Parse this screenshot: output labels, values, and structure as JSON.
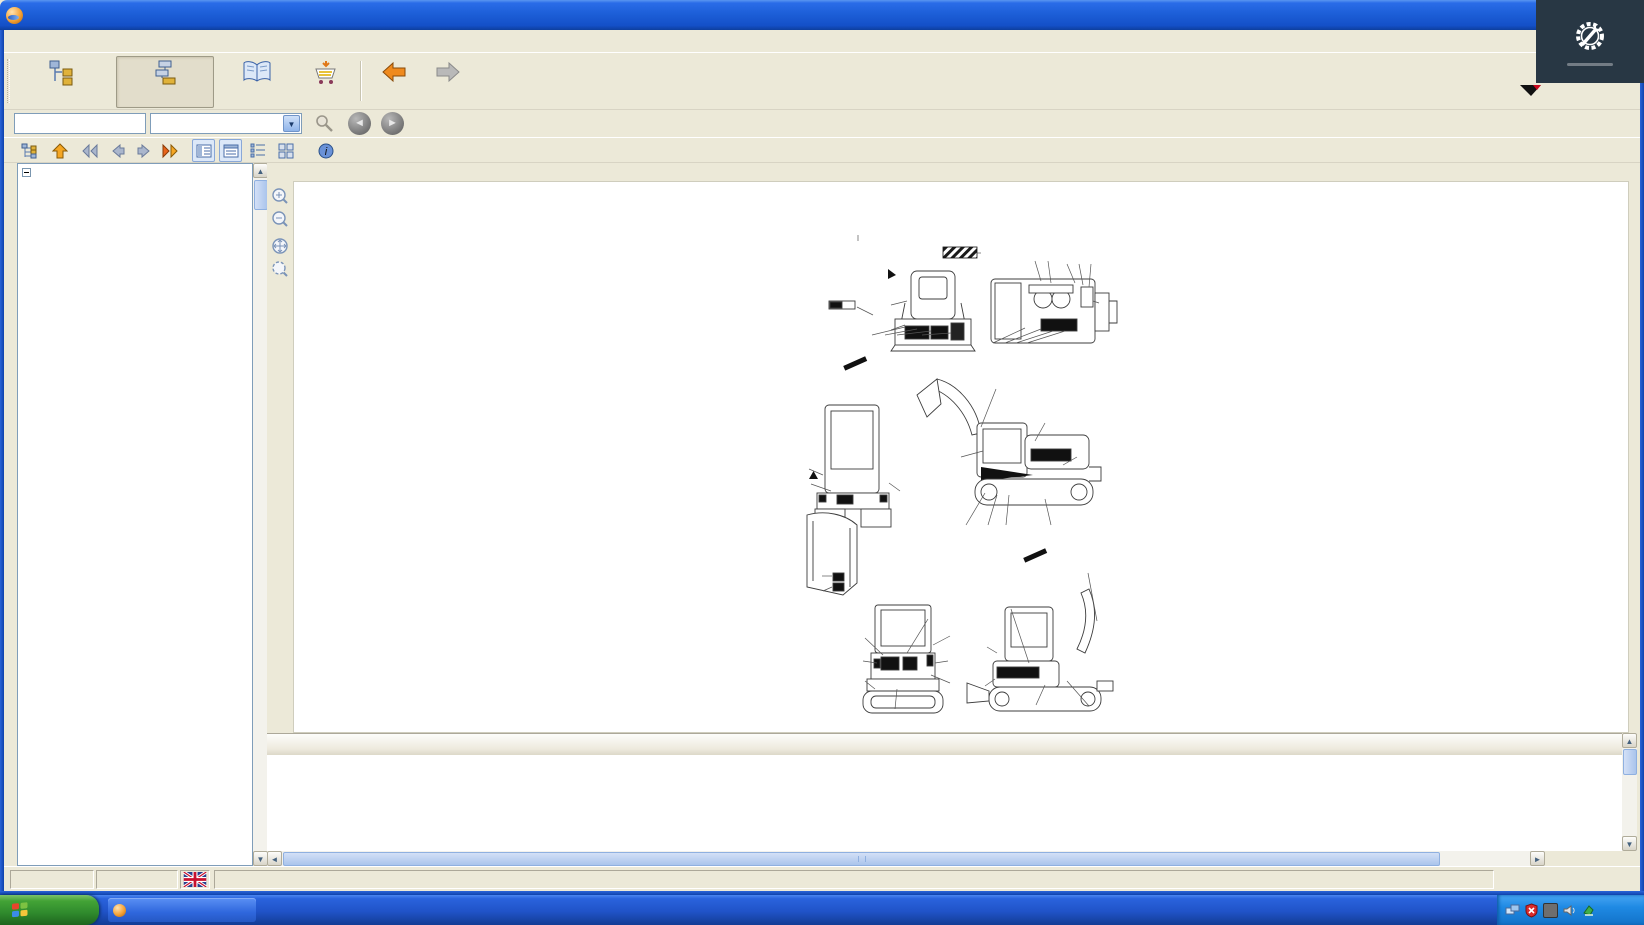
{
  "window": {
    "title": "PARTS-PUBLISHER - Catalog"
  },
  "overlay": {
    "brand": "AGCF Machinery Diag",
    "yanmar": "YANMAR"
  },
  "menu": {
    "items": [
      {
        "label": "File",
        "u": 0
      },
      {
        "label": "View",
        "u": 0
      },
      {
        "label": "Print",
        "u": 4
      },
      {
        "label": "Options",
        "u": 0
      },
      {
        "label": "Help",
        "u": 0
      }
    ]
  },
  "toolbar": {
    "main_selection": "Main selection",
    "catalogue": "Catalogue of parts",
    "documentation": "Documentation",
    "order": "Order",
    "back": "Back",
    "next": "Next"
  },
  "search": {
    "value": "",
    "field_type": "Part no."
  },
  "content": {
    "header": "(1) LABEL (CABIN SPEC.)[|->|]",
    "expand": "»"
  },
  "tree": {
    "root": "VEHICLE",
    "items": [
      {
        "label": "(1) LABEL (CABIN SPEC.)[|->|]",
        "selected": true
      },
      {
        "label": "(2) LABEL(CABIN SPEC.)[|->|]"
      },
      {
        "label": "(3) LABEL (CANOPY SPEC.)[|->|]"
      },
      {
        "label": "(4) LABEL(CANOPY SPEC.)[|->|]"
      },
      {
        "label": "(5) LABEL(UK REMODELING)OPTIONAL[|->|]"
      },
      {
        "label": "(6) TOOL,TOOLS BOX & MANUAL CASE[|->|]"
      },
      {
        "label": "(7) MUFFLER[|->|]"
      },
      {
        "label": "(8) AIR CLEANER[|->|]"
      },
      {
        "label": "(9) ACCELERATOR[|->|]"
      },
      {
        "label": "(10) ENGINE MOUNT[|->|]"
      },
      {
        "label": "(11) RADIATOR & MOUNT[|->|]"
      },
      {
        "label": "(12) FUEL TANK & FUEL LINE[|->|]"
      },
      {
        "label": "(13) BATTERY[|->|]"
      },
      {
        "label": "(14) ELECTRIC PART(CABIN SPEC.)[|->|]"
      },
      {
        "label": "(15) ELECTRIC PART(CANOPY SPEC.)[|->|]"
      },
      {
        "label": "(16) WORK LAMP[|->|]"
      },
      {
        "label": "(17) HEATER & DEFROSTER[|->|]"
      },
      {
        "label": "(18) RADIO (SWISS SPEC.)[|->|]"
      },
      {
        "label": "(19) ROLLER & ADJUST[|->|]"
      },
      {
        "label": "(20) CRAWLER (320)[|->|]"
      },
      {
        "label": "(21) LINK STAND[|->|]"
      },
      {
        "label": "(22) CONTROL EQUIPME.(BOOM & BUCKET)[|->|]"
      },
      {
        "label": "(23) CONTROL EQUIPME.(ARM & TURNING)[|->|]"
      },
      {
        "label": "(24) CONTROL EQUIPME.(DRIVE & SWING)[|->|]"
      },
      {
        "label": "(25) CONTROL EQUIPMENT (BLADE)[|->|]"
      },
      {
        "label": "(26) CONTROL EQUIPMENT(3RD VALVE)[|->|]"
      },
      {
        "label": "(27) OPERATION LEVER STOPPER[|->|]"
      },
      {
        "label": "(28) FRAME[|->|]"
      },
      {
        "label": "(29) TURNING BEARING & TURNING LOCK[|->|]"
      },
      {
        "label": "(30) FRAME COVER[|->|]"
      },
      {
        "label": "(31) STEP,INSTRUMENT PANEL & SEAT[|->|]"
      },
      {
        "label": "(32) BONNET[|->|]"
      },
      {
        "label": "(33) CANOPY[|->|]"
      },
      {
        "label": "(34) CABIN[|->|]"
      },
      {
        "label": "(35) BOOM CYLINDER(UA)(CABINE SPEC.)[|->|]"
      },
      {
        "label": "(36) BOOM CYLINDER(UZ)(CANOPY SPEC.)[|->|]"
      },
      {
        "label": "(37) ARM CYLINDER[|->|]"
      },
      {
        "label": "(38) BUCKET CYLINDER[|->|]"
      },
      {
        "label": "(39) SWING CYLINDER[|->|]"
      },
      {
        "label": "(40) BLADE CYLINDER[|->|]"
      }
    ]
  },
  "diagram": {
    "fig_label": "Fig.",
    "fig_no": "1",
    "title_jp": "メイバン(キャビン)",
    "title_en": "LABEL (CABIN SPEC.)",
    "fig_table": [
      [
        "COUNTRY",
        "AY",
        "UK",
        "EP",
        "UK(OPT"
      ],
      [
        "Fig No.",
        "1",
        "2",
        "1",
        "5"
      ]
    ],
    "app_tables": [
      {
        "x": 53,
        "y": 190,
        "rows": [
          [
            "COUNTRY",
            "AY",
            "UK",
            "EP"
          ],
          [
            [
              "APPLI-",
              "CATION"
            ],
            "○",
            "−",
            "−"
          ]
        ]
      },
      {
        "x": 282,
        "y": 191,
        "rows": [
          [
            "COUNTRY",
            "AY",
            "UK",
            "EP"
          ],
          [
            [
              "APPLI-",
              "CATION"
            ],
            "−",
            "−",
            "○"
          ]
        ]
      },
      {
        "x": 212,
        "y": 383,
        "rows": [
          [
            "COUNTRY",
            "AY",
            "UK",
            "EP"
          ],
          [
            [
              "APPLI-",
              "CATION"
            ],
            "○",
            "−",
            "−"
          ]
        ]
      }
    ],
    "serial_note": [
      "機械NO. 打刻位置",
      "MACHINE SERIAL NO.",
      "IS STAMPED INTO",
      "THIS LOCATION"
    ],
    "viewed_a": [
      "Ⓐカラ見ル",
      "VIEWED FROM Ⓐ"
    ],
    "viewed_b": [
      "Ⓑカラ見ル",
      "VIEWED FROM Ⓑ"
    ],
    "machine_decal": "B27",
    "plain_labels": [
      {
        "t": "1",
        "x": 113,
        "y": 64
      },
      {
        "t": "inc. 2~39",
        "x": 100,
        "y": 74
      },
      {
        "t": "24A",
        "x": 124,
        "y": 189
      },
      {
        "t": "25",
        "x": 297,
        "y": 380
      },
      {
        "t": "◀Ⓐ",
        "x": 156,
        "y": 128
      },
      {
        "t": "◀Ⓑ",
        "x": 214,
        "y": 144
      }
    ],
    "labels": [
      {
        "n": "43",
        "x": 243,
        "y": 70
      },
      {
        "n": "32",
        "x": 290,
        "y": 73
      },
      {
        "n": "2",
        "x": 303,
        "y": 73
      },
      {
        "n": "8",
        "x": 322,
        "y": 76
      },
      {
        "n": "37",
        "x": 334,
        "y": 76
      },
      {
        "n": "36",
        "x": 346,
        "y": 76
      },
      {
        "n": "34",
        "x": 362,
        "y": 120
      },
      {
        "n": "26",
        "x": 138,
        "y": 122
      },
      {
        "n": "4",
        "x": 122,
        "y": 132
      },
      {
        "n": "23",
        "x": 138,
        "y": 147
      },
      {
        "n": "10",
        "x": 127,
        "y": 158
      },
      {
        "n": "12",
        "x": 140,
        "y": 158
      },
      {
        "n": "11",
        "x": 152,
        "y": 158
      },
      {
        "n": "46",
        "x": 177,
        "y": 158
      },
      {
        "n": "28",
        "x": 248,
        "y": 165
      },
      {
        "n": "38",
        "x": 260,
        "y": 165
      },
      {
        "n": "33",
        "x": 271,
        "y": 165
      },
      {
        "n": "8",
        "x": 282,
        "y": 165
      },
      {
        "n": "24B",
        "x": 251,
        "y": 200
      },
      {
        "n": "22",
        "x": 57,
        "y": 283
      },
      {
        "n": "27",
        "x": 58,
        "y": 301
      },
      {
        "n": "29",
        "x": 163,
        "y": 311
      },
      {
        "n": "39",
        "x": 209,
        "y": 274
      },
      {
        "n": "3",
        "x": 307,
        "y": 236
      },
      {
        "n": "14",
        "x": 340,
        "y": 272
      },
      {
        "n": "16",
        "x": 221,
        "y": 347
      },
      {
        "n": "19",
        "x": 243,
        "y": 347
      },
      {
        "n": "18",
        "x": 261,
        "y": 347
      },
      {
        "n": "21",
        "x": 306,
        "y": 347
      },
      {
        "n": "42",
        "x": 70,
        "y": 393
      },
      {
        "n": "41",
        "x": 71,
        "y": 408
      },
      {
        "n": "24B",
        "x": 343,
        "y": 384
      },
      {
        "n": "13",
        "x": 185,
        "y": 431
      },
      {
        "n": "31",
        "x": 112,
        "y": 452
      },
      {
        "n": "30",
        "x": 214,
        "y": 453
      },
      {
        "n": "5",
        "x": 111,
        "y": 478
      },
      {
        "n": "7",
        "x": 212,
        "y": 478
      },
      {
        "n": "20",
        "x": 112,
        "y": 500
      },
      {
        "n": "35",
        "x": 214,
        "y": 502
      },
      {
        "n": "6",
        "x": 150,
        "y": 531
      },
      {
        "n": "17",
        "x": 234,
        "y": 463
      },
      {
        "n": "15",
        "x": 232,
        "y": 505
      },
      {
        "n": "9",
        "x": 263,
        "y": 420
      },
      {
        "n": "18",
        "x": 291,
        "y": 528
      },
      {
        "n": "44.45",
        "x": 353,
        "y": 528
      }
    ]
  },
  "table": {
    "headers": [
      "",
      "",
      "P...",
      "L.",
      "Part number",
      "~|->",
      "->|~",
      "Description",
      "I.",
      "Q.",
      "Remarks"
    ],
    "rows": [
      {
        "p": "1B",
        "l": "1",
        "part": "772142-03701",
        "from": "",
        "to": "",
        "desc": "LABEL SET, CABINE EP",
        "i": "",
        "q": "1",
        "remarks": ""
      },
      {
        "p": "2",
        "l": "2",
        "part": "172143-03170",
        "from": "",
        "to": "",
        "desc": "LABEL",
        "i": "",
        "q": "1",
        "remarks": ""
      },
      {
        "p": "3",
        "l": "2",
        "part": "172148-03170",
        "from": "",
        "to": "",
        "desc": "LABEL, STRIPE(LB)",
        "i": "",
        "q": "1",
        "remarks": ""
      },
      {
        "p": "4",
        "l": "2",
        "part": "172143-03180",
        "from": "",
        "to": "",
        "desc": "LABEL",
        "i": "",
        "q": "1",
        "remarks": ""
      },
      {
        "p": "5",
        "l": "2",
        "part": "172148-03180",
        "from": "",
        "to": "",
        "desc": "LABEL, STRIPE(REAR A",
        "i": "",
        "q": "1",
        "remarks": ""
      }
    ]
  },
  "status": {
    "time": "10:12:22",
    "date": "2009-12-15",
    "page": "Page 1 from 1"
  },
  "taskbar": {
    "start": "start",
    "task": "PARTS-PUBLISHER - ...",
    "tray_time": "10:12",
    "vm": "vm"
  }
}
